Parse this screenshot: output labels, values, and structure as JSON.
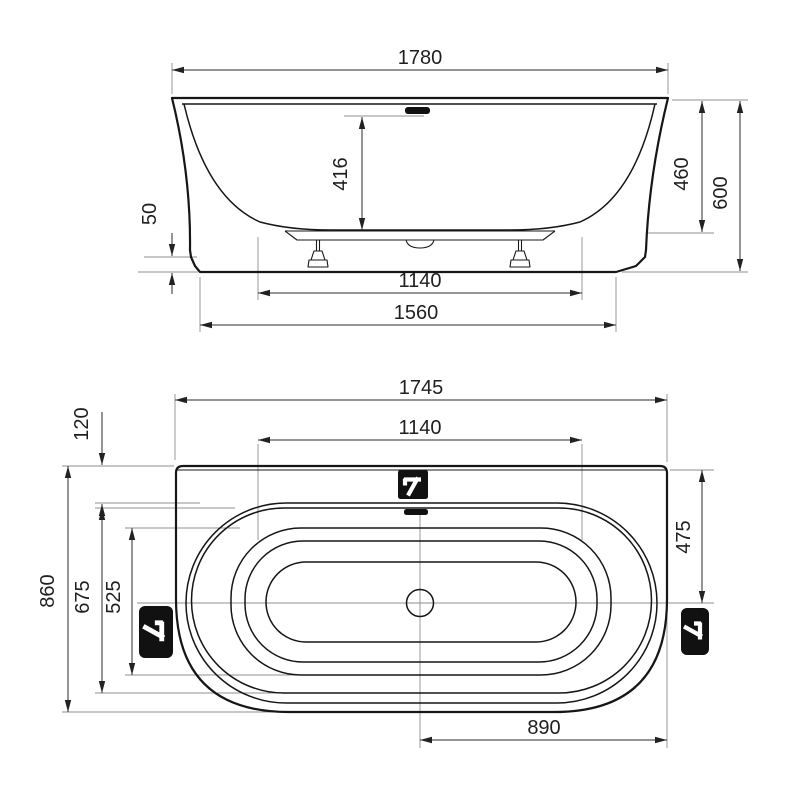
{
  "front_view": {
    "dims": {
      "overall_width": "1780",
      "basin_depth": "416",
      "rim_to_bottom": "460",
      "overall_height": "600",
      "leveling_range": "50",
      "base_width": "1140",
      "skirt_width": "1560"
    }
  },
  "plan_view": {
    "dims": {
      "overall_length": "1745",
      "deck_depth": "120",
      "base_length": "1140",
      "edge_to_center": "475",
      "overall_depth": "860",
      "outer_rim_depth": "675",
      "basin_width": "525",
      "drain_to_edge": "890"
    }
  },
  "colors": {
    "background": "#ffffff",
    "outline": "#161616",
    "dimension_line": "#2b2b2b",
    "extension_line": "#8f8f8f",
    "icon_fill": "#111111",
    "text": "#1f1f1f"
  }
}
